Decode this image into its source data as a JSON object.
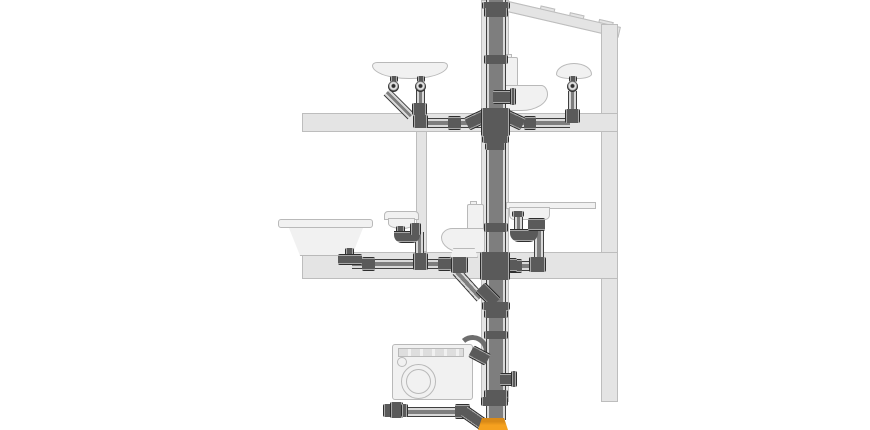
{
  "diagram": {
    "type": "building-drainage-system-cutaway",
    "main_component": "vertical-soil-stack",
    "floors": [
      {
        "name": "upper-floor",
        "fixtures": [
          "wall-hung-washbasin-two-traps",
          "toilet",
          "round-washbasin"
        ]
      },
      {
        "name": "ground-floor",
        "fixtures": [
          "bathtub",
          "washbasin-with-p-trap",
          "toilet",
          "kitchen-sink-with-p-trap"
        ]
      },
      {
        "name": "basement",
        "fixtures": [
          "washing-machine-with-drain-hose",
          "cleanout-access-cap",
          "underground-drain-line"
        ]
      }
    ],
    "outlet": "orange-underground-transition-fitting"
  },
  "colors": {
    "pipe_body": "#7e7e7e",
    "pipe_highlight": "#d8d8d8",
    "pipe_outline": "#3f3f3f",
    "fitting_body": "#5a5a5a",
    "fitting_highlight": "#a8a8a8",
    "fitting_outline": "#2e2e2e",
    "structure_fill": "#e4e4e4",
    "structure_outline": "#bdbdbd",
    "fixture_fill": "#f1f1f1",
    "fixture_outline": "#b9b9b9",
    "accent_orange": "#f5a11f",
    "background": "#ffffff"
  }
}
